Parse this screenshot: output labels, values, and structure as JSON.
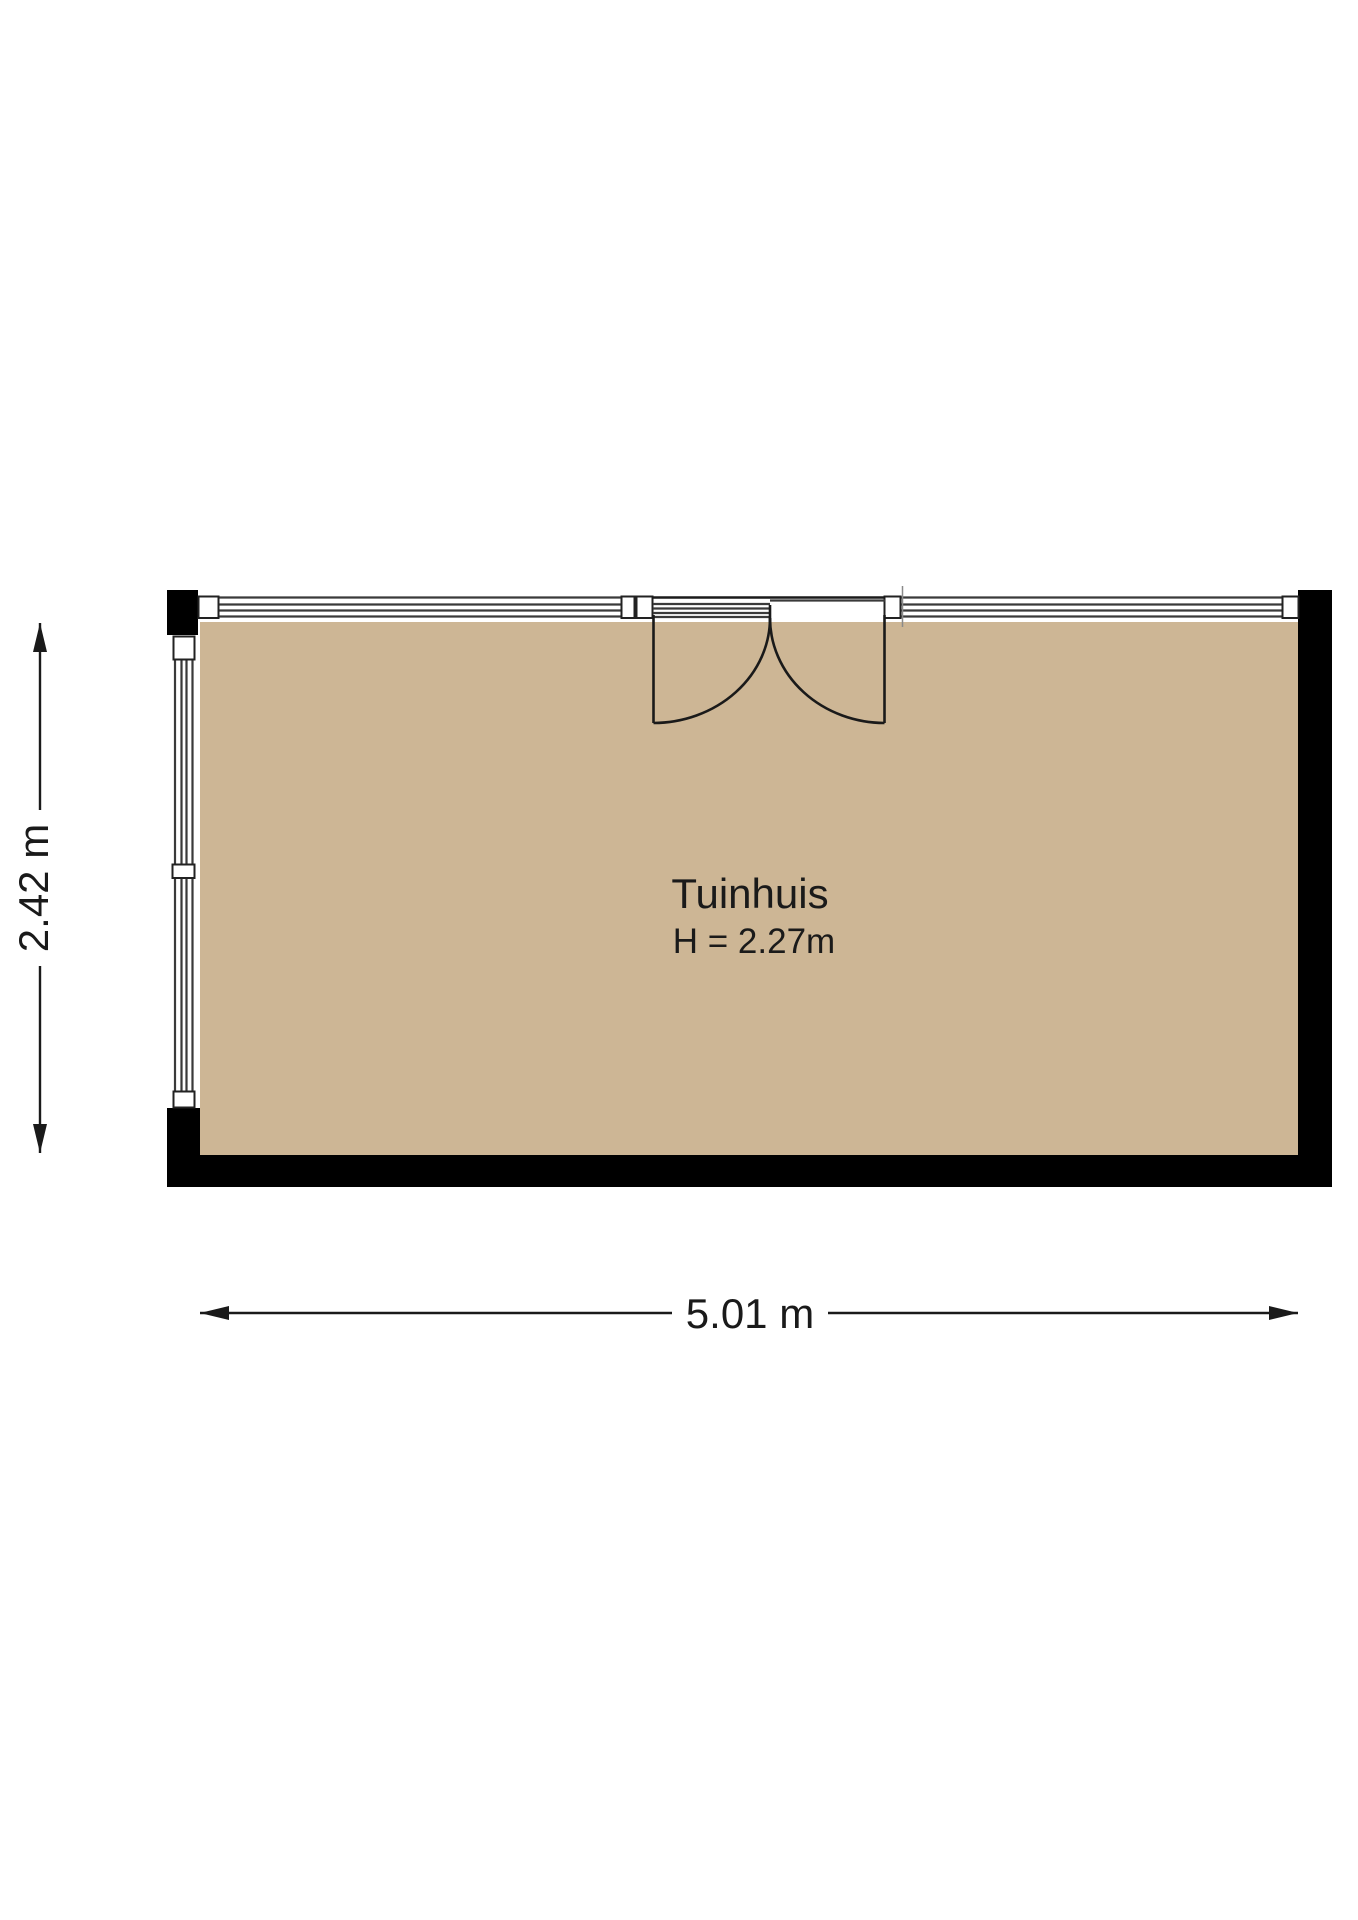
{
  "plan": {
    "room": {
      "name": "Tuinhuis",
      "height_label": "H = 2.27m"
    },
    "dimensions": {
      "width_label": "5.01 m",
      "depth_label": "2.42 m"
    }
  },
  "colors": {
    "floor": "#cdb695",
    "wall": "#000000"
  }
}
